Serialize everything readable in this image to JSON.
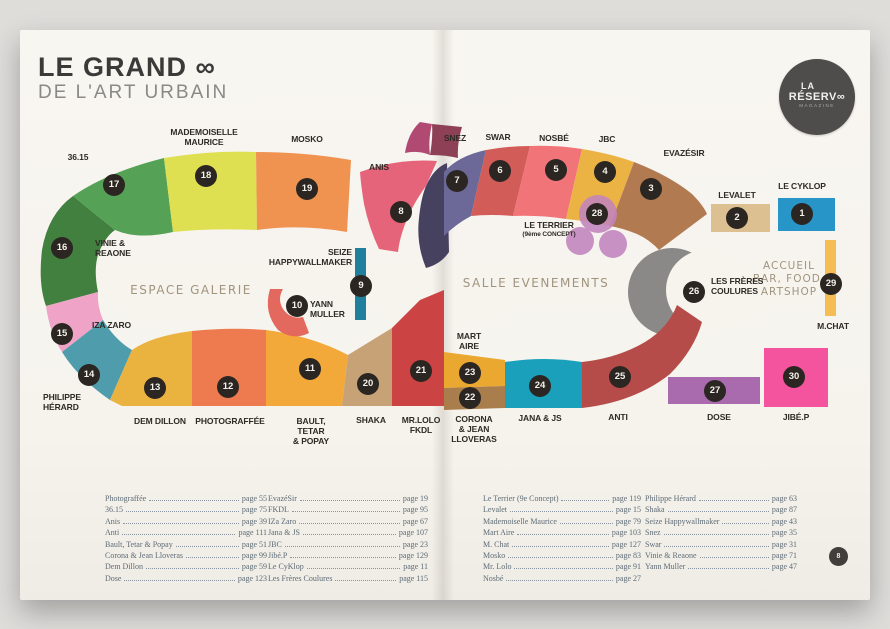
{
  "page": {
    "title_line1": "LE GRAND ∞",
    "title_line2": "DE L'ART URBAIN",
    "logo": {
      "line1": "LA",
      "line2": "RÉSERV∞",
      "line3": "MAGAZINE"
    },
    "page_number": "8"
  },
  "map": {
    "zones": {
      "gallery": "ESPACE GALERIE",
      "events": "SALLE EVENEMENTS",
      "services": "ACCUEIL\nBAR, FOOD,\nARTSHOP"
    },
    "booths": [
      {
        "num": "1",
        "label": "LE CYKLOP"
      },
      {
        "num": "2",
        "label": "LEVALET"
      },
      {
        "num": "3",
        "label": "EVAZÉSIR"
      },
      {
        "num": "4",
        "label": "JBC"
      },
      {
        "num": "5",
        "label": "NOSBÉ"
      },
      {
        "num": "6",
        "label": "SWAR"
      },
      {
        "num": "7",
        "label": "SNEZ"
      },
      {
        "num": "8",
        "label": "ANIS"
      },
      {
        "num": "9",
        "label": "SEIZE\nHAPPYWALLMAKER"
      },
      {
        "num": "10",
        "label": "YANN\nMULLER"
      },
      {
        "num": "11",
        "label": "BAULT,\nTETAR\n& POPAY"
      },
      {
        "num": "12",
        "label": "PHOTOGRAFFÉE"
      },
      {
        "num": "13",
        "label": "DEM DILLON"
      },
      {
        "num": "14",
        "label": "PHILIPPE\nHÉRARD"
      },
      {
        "num": "15",
        "label": "IZA ZARO"
      },
      {
        "num": "16",
        "label": "VINIE &\nREAONE"
      },
      {
        "num": "17",
        "label": "36.15"
      },
      {
        "num": "18",
        "label": "MADEMOISELLE\nMAURICE"
      },
      {
        "num": "19",
        "label": "MOSKO"
      },
      {
        "num": "20",
        "label": "SHAKA"
      },
      {
        "num": "21",
        "label": "MR.LOLO\nFKDL"
      },
      {
        "num": "22",
        "label": "CORONA\n& JEAN\nLLOVERAS"
      },
      {
        "num": "23",
        "label": "MART\nAIRE"
      },
      {
        "num": "24",
        "label": "JANA & JS"
      },
      {
        "num": "25",
        "label": "ANTI"
      },
      {
        "num": "26",
        "label": "LES FRÈRES\nCOULURES"
      },
      {
        "num": "27",
        "label": "DOSE"
      },
      {
        "num": "28",
        "label": "LE TERRIER",
        "sublabel": "(9ème CONCEPT)"
      },
      {
        "num": "29",
        "label": "M.CHAT"
      },
      {
        "num": "30",
        "label": "JIBÉ.P"
      }
    ],
    "colors": {
      "booth_1": "#2895c8",
      "booth_2": "#dcc091",
      "booth_3": "#b27a51",
      "booth_4": "#eab343",
      "booth_5": "#f17478",
      "booth_6": "#d25c57",
      "booth_7": "#6c6897",
      "booth_8": "#e66479",
      "booth_9": "#1f7f9d",
      "booth_10": "#e3685e",
      "booth_11": "#f2a93a",
      "booth_12": "#ee7b50",
      "booth_13": "#eab23e",
      "booth_14": "#4f9dac",
      "booth_15": "#efa3c6",
      "booth_16": "#42803f",
      "booth_17": "#55a257",
      "booth_18": "#dfdf52",
      "booth_19": "#f09351",
      "booth_20": "#c6a276",
      "booth_21": "#cb4343",
      "booth_22": "#aa7d4c",
      "booth_23": "#eaa831",
      "booth_24": "#1ba0bb",
      "booth_25": "#b54c49",
      "booth_26": "#8b8987",
      "booth_27": "#a96bae",
      "booth_28": "#c183bd",
      "booth_29": "#f6bd55",
      "booth_30": "#f4539d"
    }
  },
  "toc": {
    "columns": [
      [
        {
          "n": "Photograffée",
          "p": "page 55"
        },
        {
          "n": "36.15",
          "p": "page 75"
        },
        {
          "n": "Anis",
          "p": "page 39"
        },
        {
          "n": "Anti",
          "p": "page 111"
        },
        {
          "n": "Bault, Tetar & Popay",
          "p": "page 51"
        },
        {
          "n": "Corona & Jean Lloveras",
          "p": "page 99"
        },
        {
          "n": "Dem Dillon",
          "p": "page 59"
        },
        {
          "n": "Dose",
          "p": "page 123"
        }
      ],
      [
        {
          "n": "EvazéSir",
          "p": "page 19"
        },
        {
          "n": "FKDL",
          "p": "page 95"
        },
        {
          "n": "IZa Zaro",
          "p": "page 67"
        },
        {
          "n": "Jana & JS",
          "p": "page 107"
        },
        {
          "n": "JBC",
          "p": "page 23"
        },
        {
          "n": "Jibé.P",
          "p": "page 129"
        },
        {
          "n": "Le CyKlop",
          "p": "page 11"
        },
        {
          "n": "Les Frères Coulures",
          "p": "page 115"
        }
      ],
      [
        {
          "n": "Le Terrier (9e Concept)",
          "p": "page 119"
        },
        {
          "n": "Levalet",
          "p": "page 15"
        },
        {
          "n": "Mademoiselle Maurice",
          "p": "page 79"
        },
        {
          "n": "Mart Aire",
          "p": "page 103"
        },
        {
          "n": "M. Chat",
          "p": "page 127"
        },
        {
          "n": "Mosko",
          "p": "page 83"
        },
        {
          "n": "Mr. Lolo",
          "p": "page 91"
        },
        {
          "n": "Nosbé",
          "p": "page 27"
        }
      ],
      [
        {
          "n": "Philippe Hérard",
          "p": "page 63"
        },
        {
          "n": "Shaka",
          "p": "page 87"
        },
        {
          "n": "Seize Happywallmaker",
          "p": "page 43"
        },
        {
          "n": "Snez",
          "p": "page 35"
        },
        {
          "n": "Swar",
          "p": "page 31"
        },
        {
          "n": "Vinie & Reaone",
          "p": "page 71"
        },
        {
          "n": "Yann Muller",
          "p": "page 47"
        }
      ]
    ]
  }
}
